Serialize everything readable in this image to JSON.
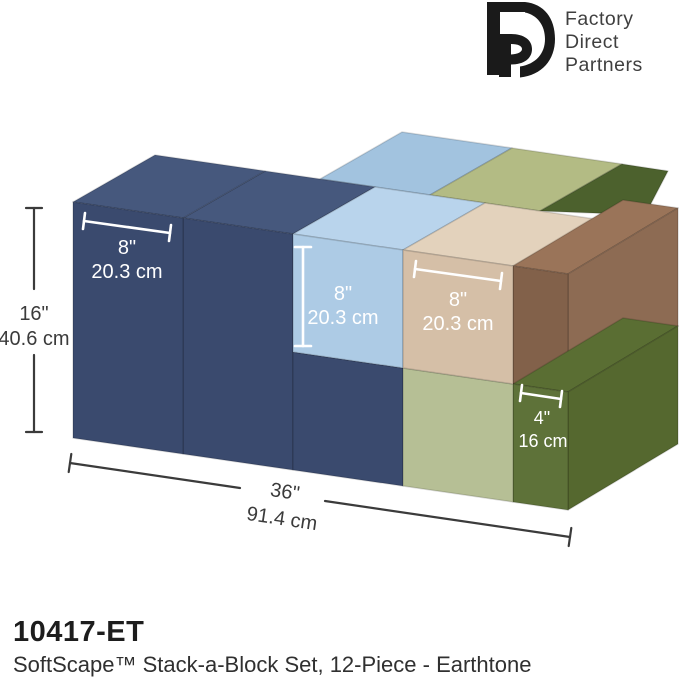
{
  "brand": {
    "monogram": "FDP",
    "lines": [
      "Factory",
      "Direct",
      "Partners"
    ]
  },
  "caption": {
    "sku": "10417-ET",
    "title": "SoftScape™ Stack-a-Block Set, 12-Piece - Earthtone"
  },
  "annotations": {
    "navy_width": {
      "in": "8\"",
      "cm": "20.3 cm"
    },
    "blue_height": {
      "in": "8\"",
      "cm": "20.3 cm"
    },
    "beige_width": {
      "in": "8\"",
      "cm": "20.3 cm"
    },
    "olive_width": {
      "in": "4\"",
      "cm": "16 cm"
    },
    "total_height": {
      "in": "16\"",
      "cm": "40.6 cm"
    },
    "total_width": {
      "in": "36\"",
      "cm": "91.4 cm"
    }
  },
  "colors": {
    "logo_black": "#1a1a1a",
    "navy_front": "#3a4a6e",
    "navy_top": "#46587d",
    "lightblue_front": "#adcbe5",
    "lightblue_top": "#b9d4ec",
    "lightblue_back_top": "#a2c3df",
    "sage_front": "#b6bf95",
    "sage_back_top": "#b3bb84",
    "beige_front": "#d5bfa7",
    "beige_top": "#e3d2bc",
    "brown_front": "#82614a",
    "brown_right": "#8d6b53",
    "brown_top": "#9a7459",
    "olive_front": "#5e7239",
    "olive_right": "#55682f",
    "olive_top": "#5a6e33",
    "olive_back_top": "#4c612d",
    "dimension_line_white": "#ffffff",
    "dimension_line_dark": "#3b3b3b"
  }
}
